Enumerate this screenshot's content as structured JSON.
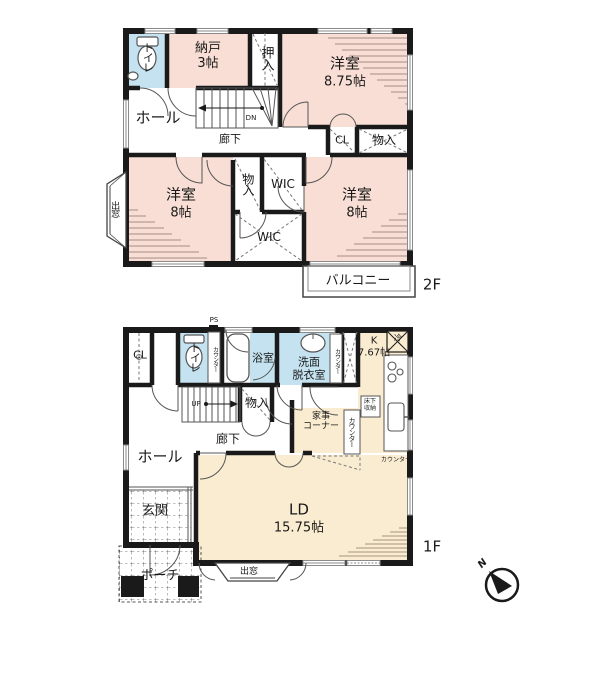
{
  "title": "2階建て住宅 間取り図",
  "colors": {
    "wall": "#1a1a1a",
    "room_pink": "#f8ded4",
    "room_cream": "#faecd1",
    "room_blue": "#c5e2f0"
  },
  "floor2": {
    "floor_label": "2F",
    "toilet": "トイレ",
    "nando": {
      "name": "納戸",
      "size": "3帖"
    },
    "oshiire": "押入",
    "western_875": {
      "name": "洋室",
      "size": "8.75帖"
    },
    "hall": "ホール",
    "corridor": "廊下",
    "stairs_down": "DN",
    "closet": "CL",
    "storage_right": "物入",
    "bay_window": "出窓",
    "western_8_left": {
      "name": "洋室",
      "size": "8帖"
    },
    "storage_mid": "物入",
    "wic_top": "WIC",
    "wic_bottom": "WIC",
    "western_8_right": {
      "name": "洋室",
      "size": "8帖"
    },
    "balcony": "バルコニー"
  },
  "floor1": {
    "floor_label": "1F",
    "closet": "CL",
    "ps": "PS",
    "toilet": "トイレ",
    "counter_toilet": "カウンター",
    "bath": "浴室",
    "washroom": {
      "lines": [
        "洗面",
        "脱衣室"
      ]
    },
    "counter_wash": "カウンター",
    "kitchen": {
      "name": "K",
      "size": "7.67帖"
    },
    "fridge": "冷",
    "floor_storage": {
      "lines": [
        "床下",
        "収納"
      ]
    },
    "stairs_up": "UP",
    "storage": "物入",
    "corridor": "廊下",
    "hall": "ホール",
    "kaji_corner": {
      "lines": [
        "家事",
        "コーナー"
      ]
    },
    "counter_kaji": "カウンター",
    "counter_kitchen": "カウンター",
    "ld": {
      "name": "LD",
      "size": "15.75帖"
    },
    "genkan": "玄関",
    "porch": "ポーチ",
    "bay_window": "出窓"
  },
  "compass": {
    "north_label": "N"
  }
}
